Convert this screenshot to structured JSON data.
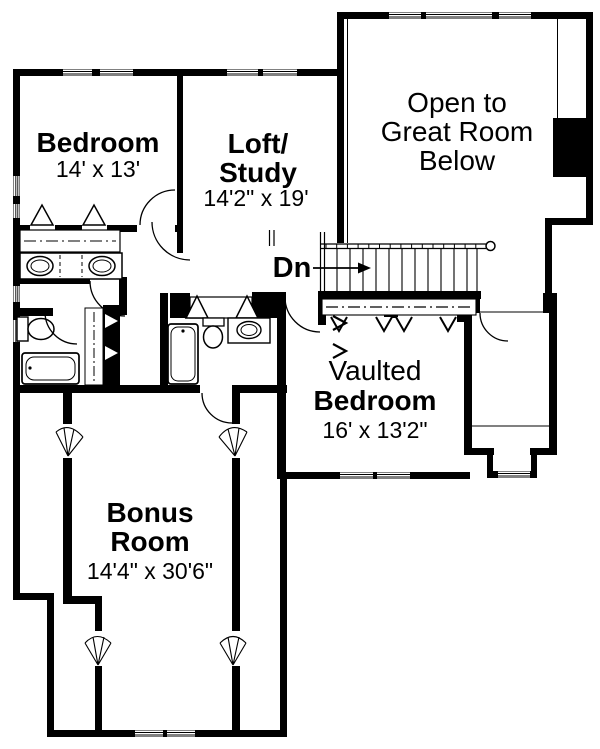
{
  "plan": {
    "type": "second-floor-plan",
    "colors": {
      "wall": "#000000",
      "floor": "#ffffff"
    },
    "rooms": {
      "bedroom": {
        "name": "Bedroom",
        "dims": "14' x 13'"
      },
      "loft": {
        "line1": "Loft/",
        "line2": "Study",
        "dims": "14'2\" x 19'"
      },
      "great_room": {
        "line1": "Open to",
        "line2": "Great Room",
        "line3": "Below"
      },
      "vaulted": {
        "qualifier": "Vaulted",
        "name": "Bedroom",
        "dims": "16' x 13'2\""
      },
      "bonus": {
        "line1": "Bonus",
        "line2": "Room",
        "dims": "14'4\" x 30'6\""
      }
    },
    "stairs": {
      "label": "Dn"
    }
  }
}
